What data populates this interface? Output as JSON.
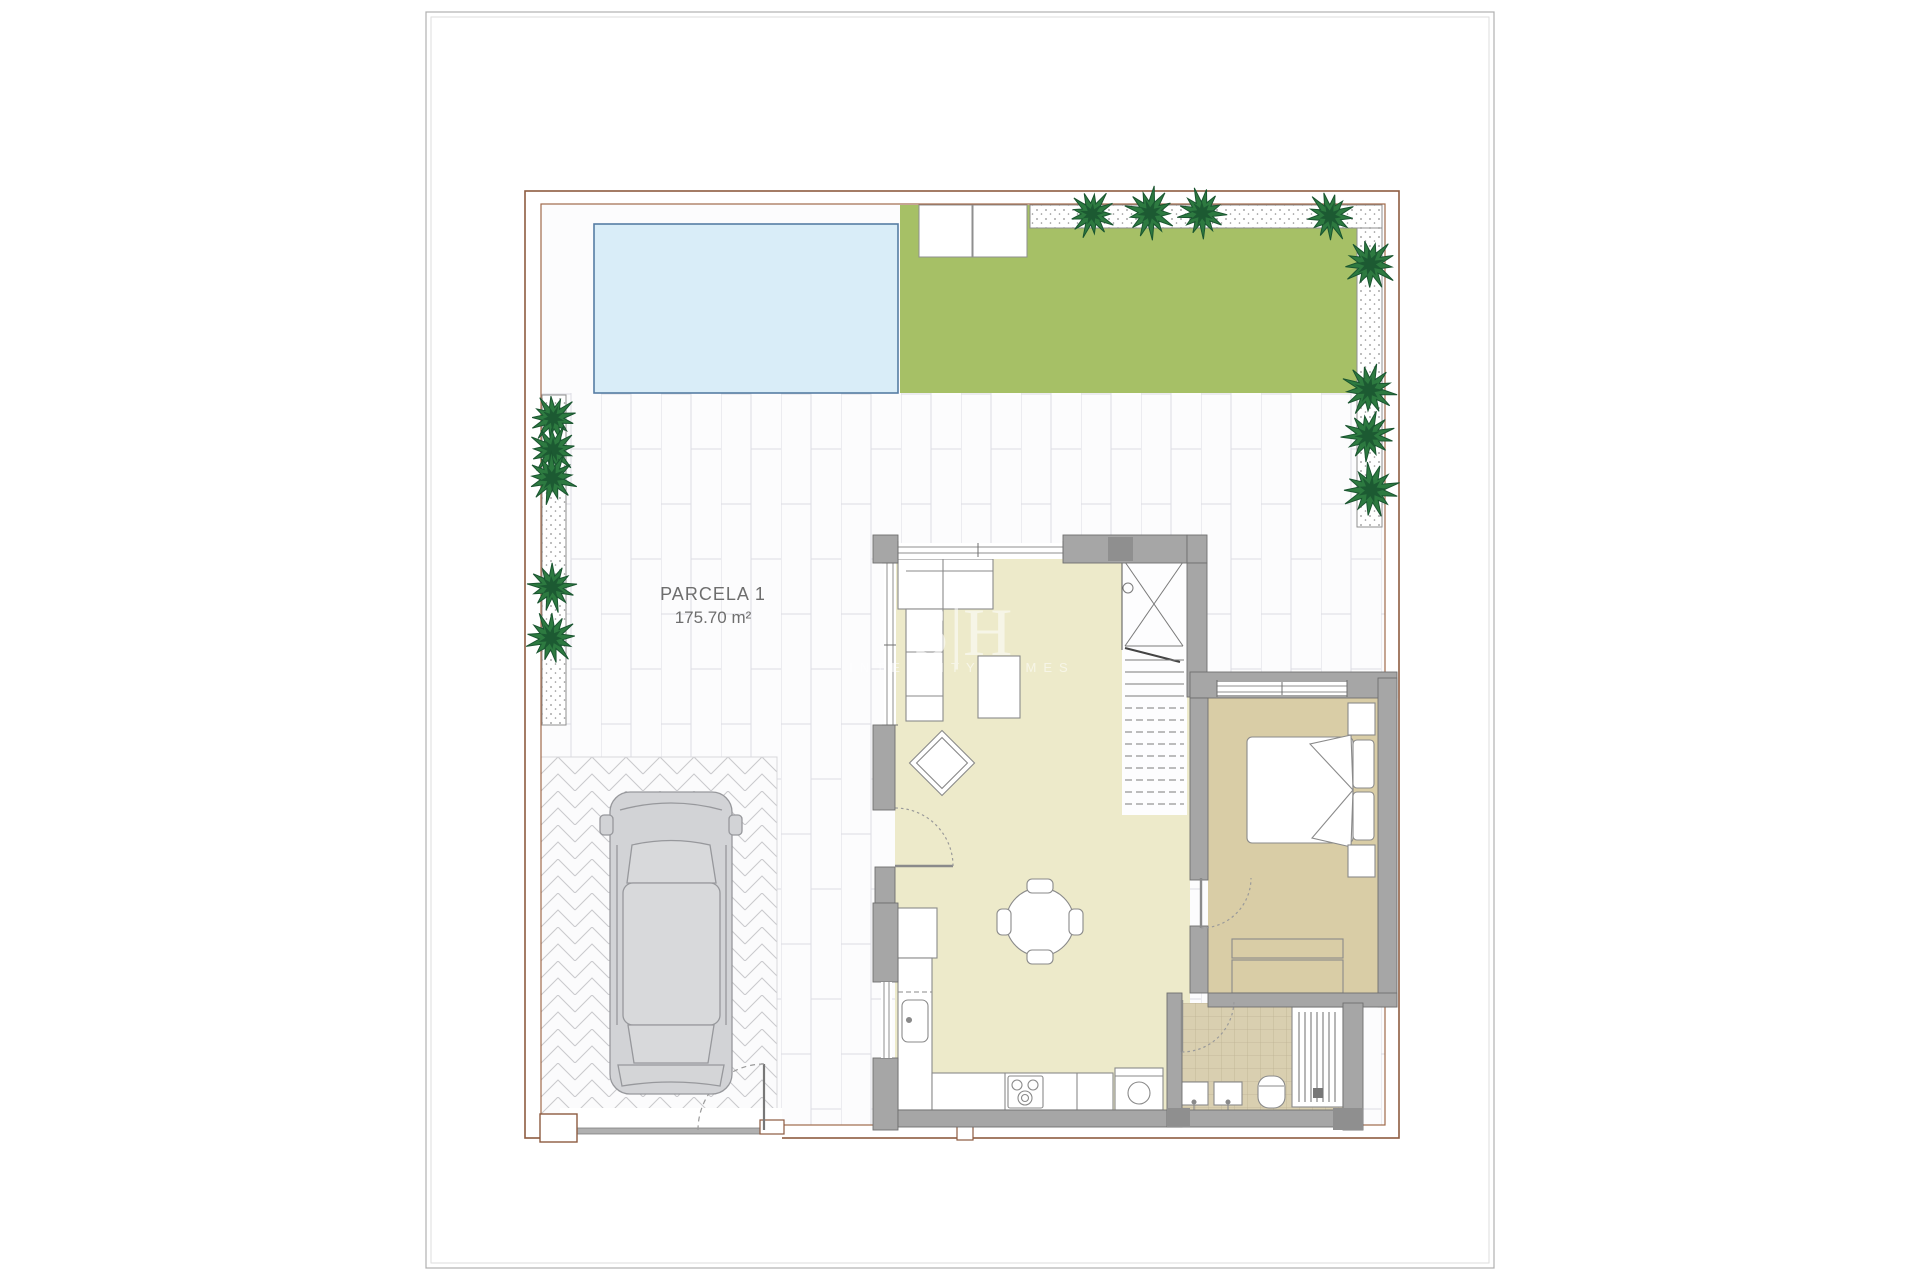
{
  "title_block": {
    "parcel_label": "PARCELA 1",
    "parcel_area": "175.70 m²"
  },
  "watermark": {
    "monogram": "S|H",
    "caption": "INTEGRITY HOMES"
  },
  "colors": {
    "sheet_border": "#b0b0b0",
    "sheet_border_inner": "#dedede",
    "plot_border": "#8d5b40",
    "plot_border_inner": "#a06a4a",
    "terrace_base": "#fcfcfd",
    "tile_line": "#dcdce3",
    "pool_fill": "#d9edf8",
    "pool_stroke": "#567da4",
    "garden_fill": "#a6c066",
    "gravel_stroke": "#8f8f8f",
    "gravel_dot": "#909090",
    "tree": "#2d7a40",
    "tree_dark": "#1a5530",
    "herringbone_line": "#c9c9cd",
    "wall_fill": "#a6a6a6",
    "wall_stroke": "#6f6f6f",
    "wall_dark": "#8f8f8f",
    "floor_living": "#edeaca",
    "floor_bedroom": "#d9cda6",
    "bath_tile": "#d9cfb0",
    "bath_grid": "#bfb394",
    "furniture_stroke": "#8a8a8a",
    "door_arc": "#9a9a9a",
    "car_fill": "#d2d3d6",
    "car_stroke": "#97989c",
    "label_text": "#6e6e6e",
    "gate_bar": "#b0b0b0"
  },
  "plan": {
    "trees": [
      {
        "x": 1092,
        "y": 214,
        "r": 24
      },
      {
        "x": 1150,
        "y": 213,
        "r": 26
      },
      {
        "x": 1202,
        "y": 213,
        "r": 25
      },
      {
        "x": 1330,
        "y": 216,
        "r": 25
      },
      {
        "x": 1370,
        "y": 264,
        "r": 27
      },
      {
        "x": 1369,
        "y": 390,
        "r": 27
      },
      {
        "x": 1368,
        "y": 436,
        "r": 26
      },
      {
        "x": 1371,
        "y": 490,
        "r": 28
      },
      {
        "x": 553,
        "y": 418,
        "r": 24
      },
      {
        "x": 553,
        "y": 450,
        "r": 25
      },
      {
        "x": 552,
        "y": 478,
        "r": 26
      },
      {
        "x": 552,
        "y": 587,
        "r": 25
      },
      {
        "x": 551,
        "y": 638,
        "r": 26
      }
    ],
    "stairs": {
      "x1": 1125,
      "x2": 1184,
      "top": 660,
      "step": 12,
      "count": 13,
      "dashed_from": 4
    }
  }
}
